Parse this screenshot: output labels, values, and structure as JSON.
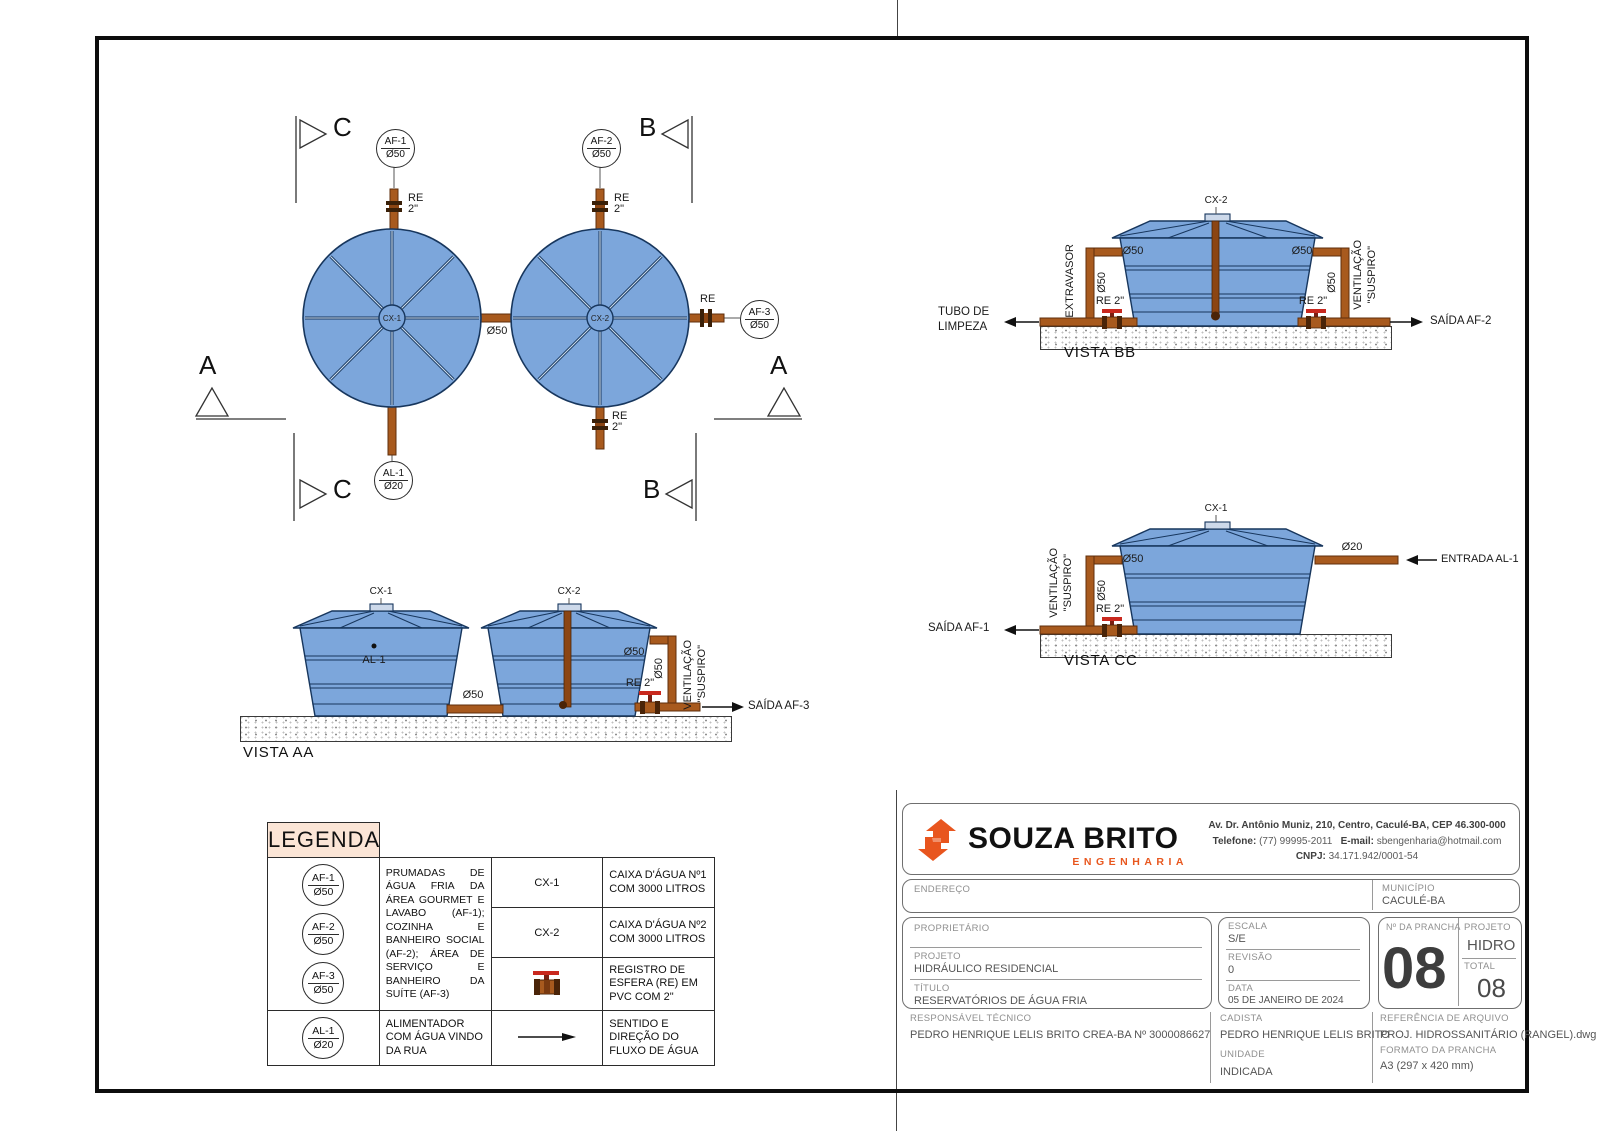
{
  "colors": {
    "tank_fill": "#7CA6DB",
    "tank_stroke": "#17365D",
    "pipe": "#A85A1E",
    "pipe_dark": "#4a2408",
    "valve_red": "#C9281E",
    "legend_header_bg": "#FBE5D6",
    "brand_orange": "#E8571E"
  },
  "labels": {
    "re": "RE",
    "size2": "2\"",
    "re2": "RE 2\"",
    "d50": "Ø50",
    "d20": "Ø20",
    "ventilacao": "VENTILAÇÃO",
    "suspiro": "\"SUSPIRO\"",
    "extravasor": "EXTRAVASOR",
    "tubo_limpeza_1": "TUBO DE",
    "tubo_limpeza_2": "LIMPEZA",
    "saida_af1": "SAÍDA AF-1",
    "saida_af2": "SAÍDA AF-2",
    "saida_af3": "SAÍDA AF-3",
    "entrada_al1": "ENTRADA AL-1",
    "cx1": "CX-1",
    "cx2": "CX-2",
    "al1": "AL-1"
  },
  "plan": {
    "marker_a": "A",
    "marker_b": "B",
    "marker_c": "C",
    "tag_af1": {
      "code": "AF-1",
      "size": "Ø50"
    },
    "tag_af2": {
      "code": "AF-2",
      "size": "Ø50"
    },
    "tag_af3": {
      "code": "AF-3",
      "size": "Ø50"
    },
    "tag_al1": {
      "code": "AL-1",
      "size": "Ø20"
    }
  },
  "vistas": {
    "aa_title": "VISTA AA",
    "bb_title": "VISTA BB",
    "cc_title": "VISTA CC"
  },
  "legend": {
    "title": "LEGENDA",
    "prumadas_desc": "PRUMADAS DE ÁGUA FRIA DA ÁREA GOURMET E LAVABO (AF-1); COZINHA E BANHEIRO SOCIAL (AF-2); ÁREA DE SERVIÇO E BANHEIRO DA SUÍTE (AF-3)",
    "cx1_code": "CX-1",
    "cx1_desc": "CAIXA D'ÁGUA Nº1 COM 3000 LITROS",
    "cx2_code": "CX-2",
    "cx2_desc": "CAIXA D'ÁGUA Nº2 COM 3000 LITROS",
    "registro_desc": "REGISTRO DE ESFERA (RE) EM PVC COM 2\"",
    "alimentador_desc": "ALIMENTADOR COM ÁGUA VINDO DA RUA",
    "sentido_desc": "SENTIDO E DIREÇÃO DO FLUXO DE ÁGUA"
  },
  "titleblock": {
    "brand_name": "SOUZA BRITO",
    "brand_sub": "ENGENHARIA",
    "address": "Av. Dr. Antônio Muniz, 210, Centro, Caculé-BA, CEP 46.300-000",
    "phone_label": "Telefone:",
    "phone": "(77) 99995-2011",
    "email_label": "E-mail:",
    "email": "sbengenharia@hotmail.com",
    "cnpj_label": "CNPJ:",
    "cnpj": "34.171.942/0001-54",
    "endereco_label": "ENDEREÇO",
    "municipio_label": "MUNICÍPIO",
    "municipio": "CACULÉ-BA",
    "proprietario_label": "PROPRIETÁRIO",
    "projeto_label": "PROJETO",
    "projeto": "HIDRÁULICO RESIDENCIAL",
    "titulo_label": "TÍTULO",
    "titulo": "RESERVATÓRIOS DE ÁGUA FRIA",
    "escala_label": "ESCALA",
    "escala": "S/E",
    "revisao_label": "REVISÃO",
    "revisao": "0",
    "data_label": "DATA",
    "data": "05 DE JANEIRO DE 2024",
    "prancha_label": "Nº DA PRANCHA",
    "prancha": "08",
    "projeto_tipo_label": "PROJETO",
    "projeto_tipo": "HIDRO",
    "total_label": "TOTAL",
    "total": "08",
    "resp_label": "RESPONSÁVEL TÉCNICO",
    "resp": "PEDRO HENRIQUE LELIS BRITO CREA-BA Nº 3000086627",
    "cadista_label": "CADISTA",
    "cadista": "PEDRO HENRIQUE LELIS BRITO",
    "unidade_label": "UNIDADE",
    "unidade": "INDICADA",
    "ref_label": "REFERÊNCIA DE ARQUIVO",
    "ref": "PROJ. HIDROSSANITÁRIO (RANGEL).dwg",
    "formato_label": "FORMATO DA PRANCHA",
    "formato": "A3 (297 x 420 mm)"
  }
}
